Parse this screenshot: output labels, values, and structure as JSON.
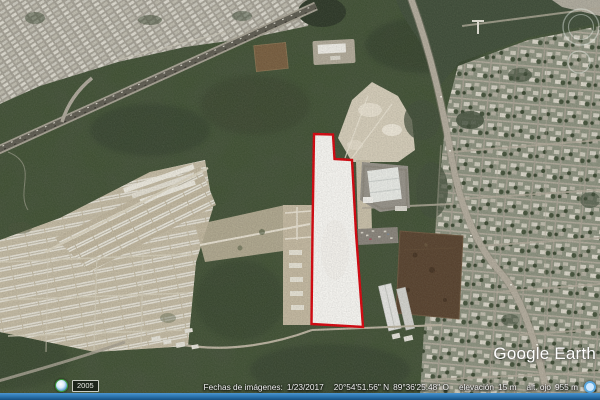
{
  "app": {
    "name": "Google Earth"
  },
  "watermark": {
    "text": "Google Earth"
  },
  "status_bar": {
    "imagery_label": "Fechas de imágenes:",
    "imagery_date": "1/23/2017",
    "latitude": "20°54'51.56\" N",
    "longitude": "89°36'25.48\" O",
    "elevation_label": "elevación",
    "elevation_value": "15 m",
    "eye_altitude_label": "alt. ojo",
    "eye_altitude_value": "955 m"
  },
  "historical_imagery": {
    "year": "2005"
  },
  "map": {
    "view": "satellite-aerial",
    "parcel": {
      "outline_color": "#e8000a",
      "fill_color": "#fbfaf6"
    }
  },
  "colors": {
    "status_bar_blue": "#2e79b4",
    "status_text": "#f2f2f2"
  }
}
